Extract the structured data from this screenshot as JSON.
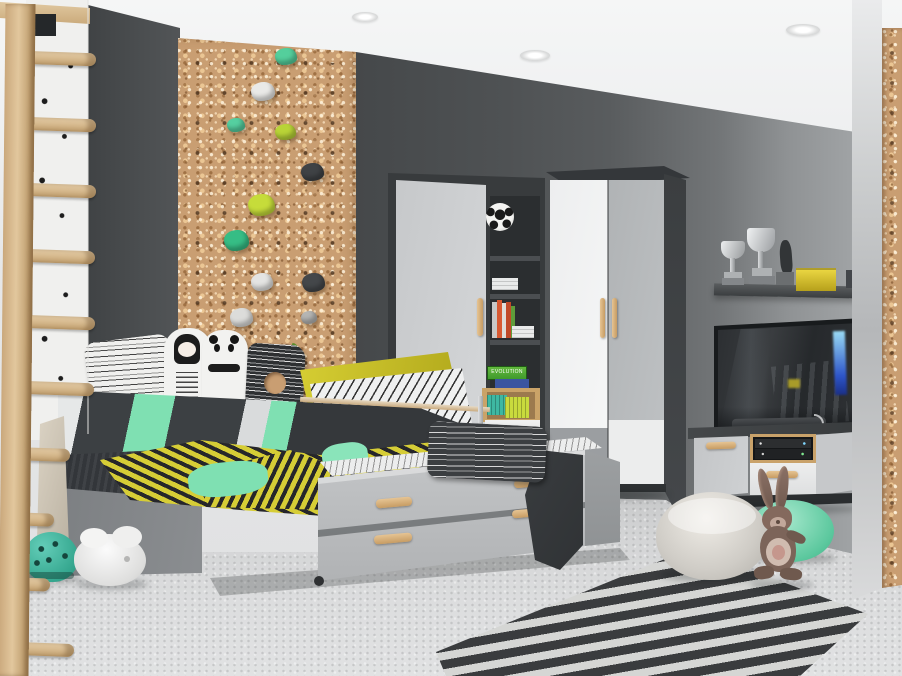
{
  "scene": {
    "description": "3D rendered kids bedroom with grey modular furniture: single bed with two trundle drawers, corner wardrobe with two-tone doors, bookcase with soccer ball and games, TV on a low media unit, wall shelf with trophies, cork climbing wall with colored holds, wooden wall bars, chevron rug, round poufs and a plush bunny"
  },
  "palette": {
    "wall_dark": "#505356",
    "wall_light": "#a4a7a8",
    "cork": "#c99e72",
    "furniture_dark": "#3e4143",
    "furniture_grey": "#b9bbbd",
    "furniture_white": "#eef0f1",
    "wood_handle": "#d7b077",
    "mint": "#7fe0b2",
    "chartreuse": "#cdc63b",
    "teal": "#45c0aa",
    "charcoal": "#393c3f",
    "rug_dark": "#3b3d3f",
    "rug_light": "#d6d7d5"
  },
  "objects": {
    "climbing_wall": "cork climbing wall with green, lime, white and grey holds",
    "wall_bars": "wooden wall bars with rope rungs",
    "bed": "grey single bed with mint, white and charcoal striped bedding and doodle pillows",
    "trundle": "pull-out trundle with two grey drawers and wooden handles",
    "bookcase": "grey bookcase with door, open shelves, books and storage crates",
    "wardrobe": "corner wardrobe with white and grey two-tone doors",
    "tv": "flat screen TV",
    "tv_stand": "grey TV stand with door, media niche and white drawer",
    "shelf": "dark grey wall shelf with two trophies, figurine and yellow radio",
    "rug": "black and white chevron rug",
    "poufs": "beige and mint round poufs",
    "bunny": "brown plush bunny toy",
    "helmet": "teal helmet",
    "bowl": "white bowl toy",
    "soccer_ball": "soccer ball",
    "game_box": "green EVOLUTION game box"
  },
  "decor": {
    "game_box_label": "EVOLUTION"
  }
}
